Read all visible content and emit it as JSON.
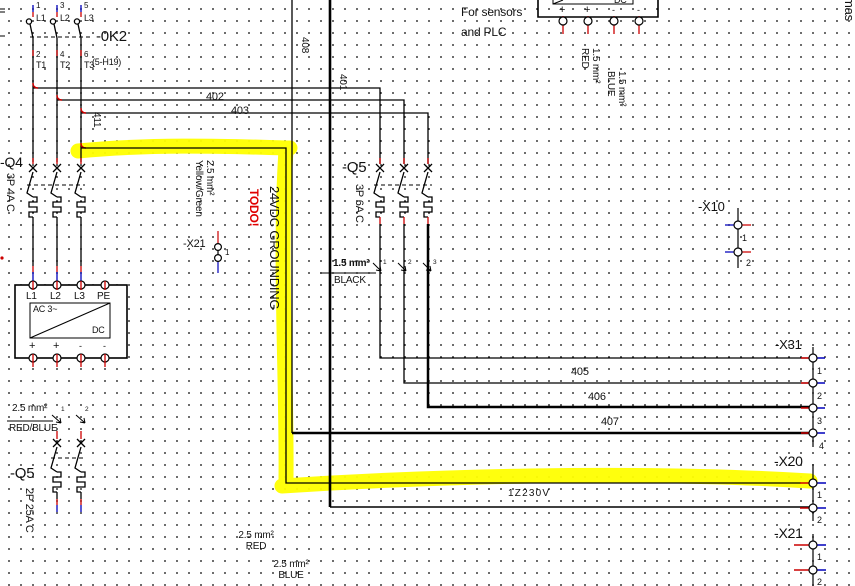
{
  "frame": {
    "edge_text": "mas"
  },
  "k2": {
    "name": "-0K2",
    "ref": "(5-H19)",
    "poles": [
      {
        "top_pin": "1",
        "top_label": "L1",
        "bot_pin": "2",
        "bot_label": "T1"
      },
      {
        "top_pin": "3",
        "top_label": "L2",
        "bot_pin": "4",
        "bot_label": "T2"
      },
      {
        "top_pin": "5",
        "top_label": "L3",
        "bot_pin": "6",
        "bot_label": "T3"
      }
    ]
  },
  "q4": {
    "name": "-Q4",
    "spec": "3P 4A C"
  },
  "q5_mid": {
    "name": "-Q5",
    "spec": "3P 6A C"
  },
  "q5_bottom": {
    "name": "-Q5",
    "spec": "2P 25A C"
  },
  "ps_left": {
    "top_terminals": [
      "L1",
      "L2",
      "L3",
      "PE"
    ],
    "ac_label": "AC 3~",
    "dc_label": "DC",
    "bottom_terminals": [
      "+",
      "+",
      "-",
      "-"
    ]
  },
  "ps_right": {
    "note_line1": "For sensors",
    "note_line2": "and PLC",
    "dc_label": "DC",
    "bottom_terminals": [
      "+",
      "+",
      "-",
      "-"
    ]
  },
  "ferrule_mid": {
    "size": "1.5 mm²",
    "color": "BLACK",
    "pins": [
      "1",
      "2",
      "3"
    ]
  },
  "ferrule_left": {
    "size": "2.5 mm²",
    "color": "RED/BLUE",
    "pins": [
      "1",
      "2"
    ]
  },
  "wire_specs": {
    "red15": {
      "size": "1.5 mm²",
      "color": "RED"
    },
    "blue15": {
      "size": "1.5 mm²",
      "color": "BLUE"
    },
    "red25": {
      "size": "2.5 mm²",
      "color": "RED"
    },
    "blue25": {
      "size": "2.5 mm²",
      "color": "BLUE"
    },
    "yg25": {
      "size": "2.5 mm²",
      "color": "Yellow/Green"
    }
  },
  "wires": {
    "w402": "402",
    "w403": "403",
    "w411": "411",
    "w408": "408",
    "w401": "401",
    "w405": "405",
    "w406": "406",
    "w407": "407",
    "w230": "1Z230V"
  },
  "annotations": {
    "todo": "TODO!",
    "grounding": "24VDC GROUNDING"
  },
  "terminals": {
    "x21_mid": {
      "name": "-X21",
      "pins": [
        "1"
      ]
    },
    "x10": {
      "name": "-X10",
      "pins": [
        "1",
        "2"
      ]
    },
    "x31": {
      "name": "-X31",
      "pins": [
        "1",
        "2",
        "3",
        "4"
      ]
    },
    "x20": {
      "name": "-X20",
      "pins": [
        "1",
        "2"
      ]
    },
    "x21_br": {
      "name": "-X21",
      "pins": [
        "1",
        "2"
      ]
    }
  },
  "colors": {
    "highlight": "#ffff00",
    "todo_red": "#ff0000",
    "terminal_red": "#cc0000",
    "terminal_blue": "#0000bb"
  }
}
